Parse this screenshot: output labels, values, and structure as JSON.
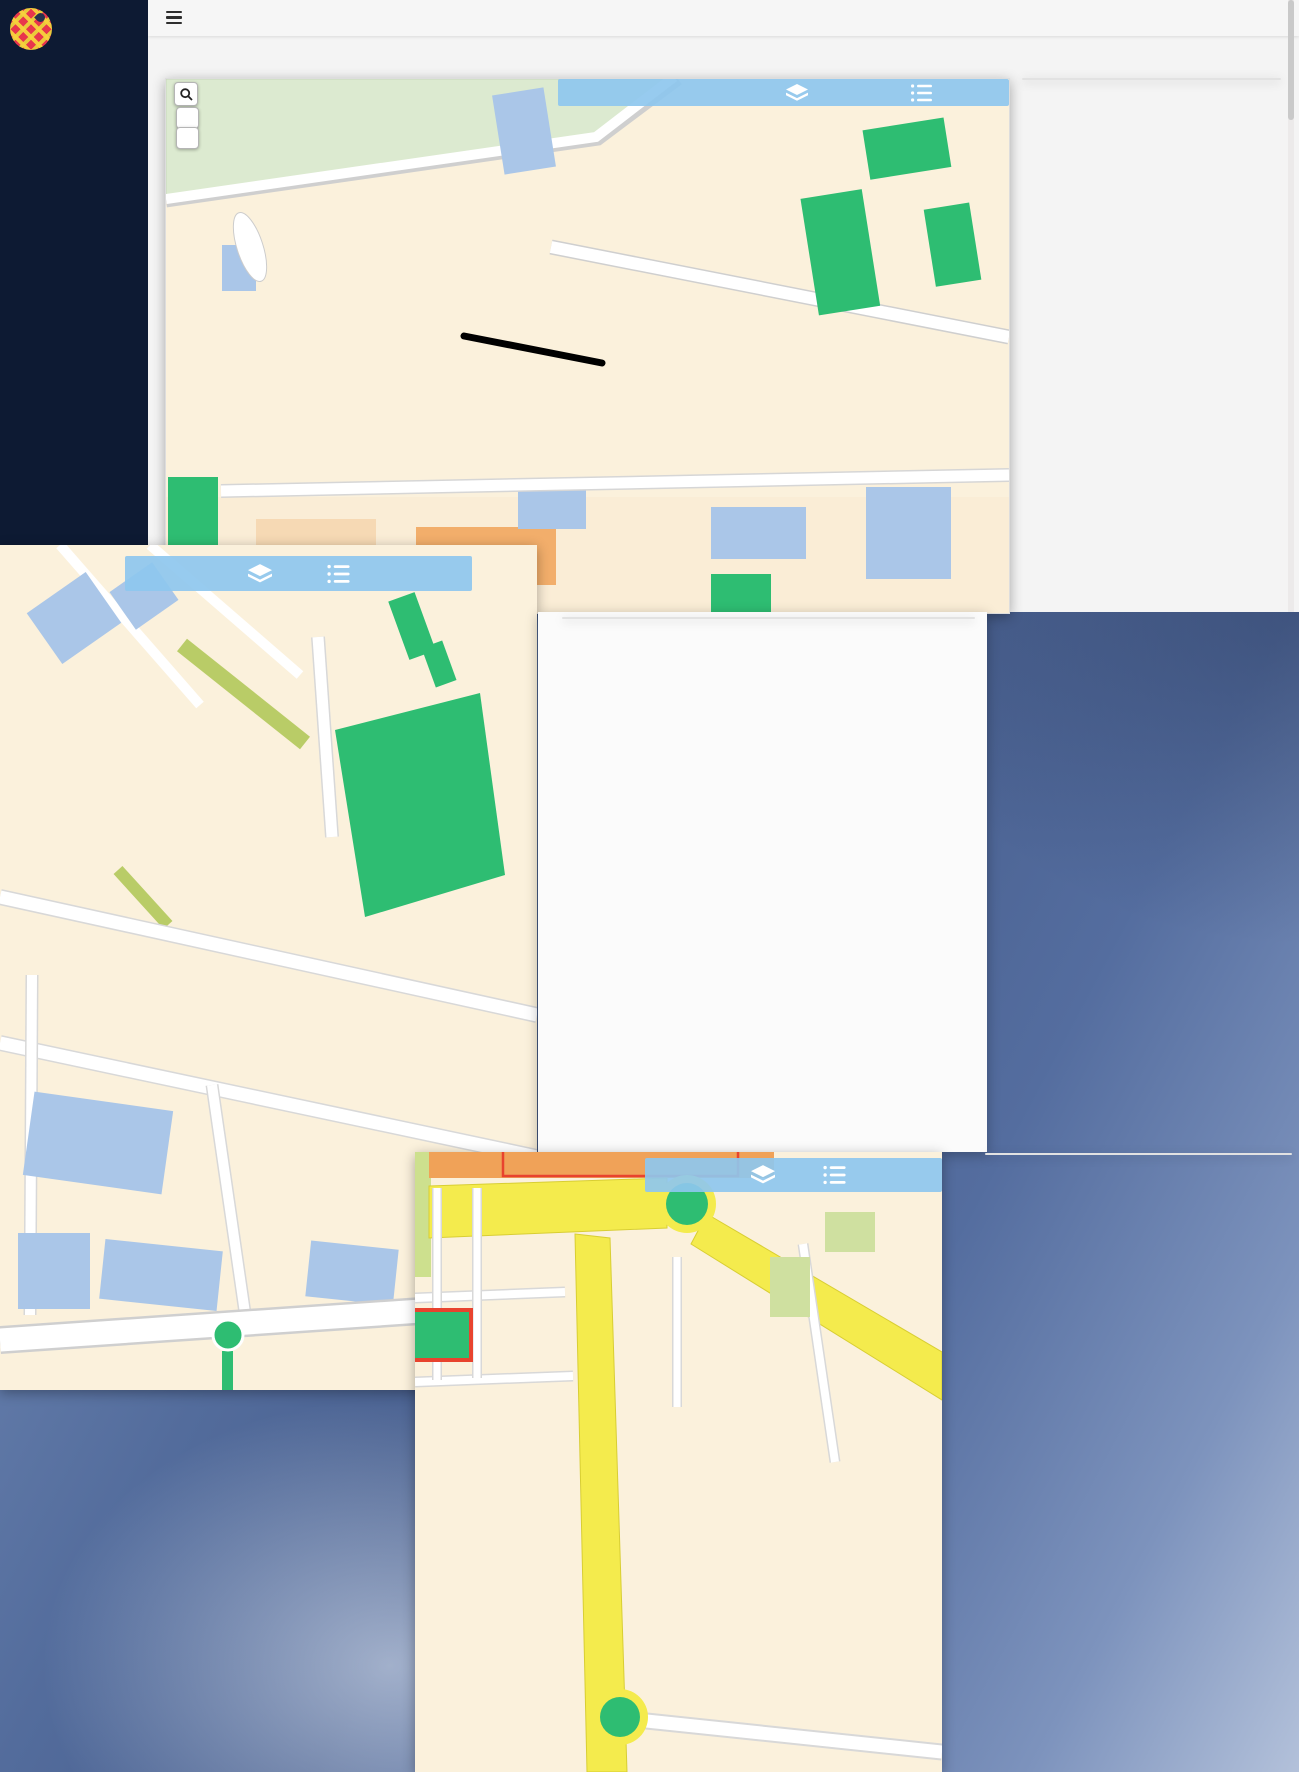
{
  "app": {
    "sidebar": {
      "logo_line1": "BOMBERO",
      "logo_line2": "CALLEJERO",
      "connected_label": "Conectado como:",
      "username": "silviaocon",
      "menu": [
        {
          "icon": "users-icon",
          "label": "Mi cuenta"
        },
        {
          "icon": "folder-icon",
          "label": "Test Interactivos"
        },
        {
          "icon": "file-icon",
          "label": "Simulacros"
        },
        {
          "icon": "list-alt-icon",
          "label": "Test Clásicos"
        },
        {
          "icon": "grid-icon",
          "label": "Mis pedidos"
        },
        {
          "icon": "power-icon",
          "label": "Salir"
        }
      ]
    },
    "topbar": {
      "menu_icon": "hamburger-icon"
    },
    "page_title": "Realizar Test",
    "map_controls": {
      "search_icon": "search-icon",
      "zoom_in_label": "+",
      "zoom_out_label": "−",
      "bar_icons": [
        "layers-icon",
        "list-icon"
      ]
    }
  },
  "common": {
    "question_title_prefix": "Pregunta N°",
    "panel_icons": [
      "heart-icon",
      "envelope-icon"
    ],
    "nav_icons": [
      "chevron-left-icon",
      "chevron-right-icon"
    ],
    "hint": "Marca una de las opciones propuestas.",
    "save_label": "Guardar Test",
    "reset_label": "Reiniciar Test",
    "total_questions": 70
  },
  "questions": [
    {
      "mount": "panel-q1",
      "number": "1",
      "question": "¿Qué calle falta?:",
      "subtitle": "",
      "options": [
        "A - Villa de Oña",
        "B - Pedro de Moya",
        "C - Alcalde Alonso Enríquez",
        "D - Gabriela Mistral"
      ],
      "prev_light": true,
      "grid": {
        "current": 1,
        "wrong": [],
        "correct": []
      }
    },
    {
      "mount": "panel-q2",
      "number": "2",
      "question": "¿En qué calle se ubica?:",
      "subtitle": "Instituto de Astrofísica de Andalucía",
      "options": [
        "A - Joaquín Blume",
        "B - Camino Bajo de Huétor",
        "C - Cuesta del Observatorio",
        "D - Paseo de los Basilios"
      ],
      "prev_light": false,
      "grid": {
        "current": 2,
        "wrong": [],
        "correct": []
      }
    },
    {
      "mount": "panel-q4",
      "number": "4",
      "question": "¿A que distrito pertenece la calle?:",
      "subtitle": "",
      "options": [
        "A - Chana",
        "B - Norte",
        "C - Genil",
        "D - Centro"
      ],
      "prev_light": false,
      "grid": {
        "current": 4,
        "wrong": [
          2
        ],
        "correct": [
          3
        ]
      }
    }
  ],
  "overlays": {
    "right_text": [
      "TRABAJA SOBRE",
      "PLANO NORMAL",
      "PARA COMENZAR A",
      "APRENDER LAS",
      "LOCALIZACIONES"
    ],
    "left_text": [
      "CALLES Y",
      "LUGARES DE",
      "INTERÉS"
    ]
  },
  "maps": {
    "map1": {
      "labels": [
        {
          "t": "o de los Yeseros",
          "x": 62,
          "y": 38,
          "r": -13
        },
        {
          "t": "Juan Niño",
          "x": 292,
          "y": 22,
          "r": -33
        },
        {
          "t": "Maestre Diego",
          "x": 262,
          "y": 58,
          "r": -62
        },
        {
          "t": "Cristóbal Caro",
          "x": 398,
          "y": 34,
          "r": -62
        },
        {
          "t": "Bartolomé de Triana",
          "x": 430,
          "y": 88,
          "r": -62
        },
        {
          "t": "José María Bugella",
          "x": 512,
          "y": 32,
          "r": -12
        },
        {
          "t": "Cándido García Ortiz Villajos",
          "x": 440,
          "y": 152,
          "r": -68
        },
        {
          "t": "Escudero García",
          "x": 598,
          "y": 62,
          "r": -50
        },
        {
          "t": "Fandango",
          "x": 520,
          "y": 96,
          "r": -58
        },
        {
          "t": "Media Granaina",
          "x": 550,
          "y": 124,
          "r": -58
        },
        {
          "t": "Tientos",
          "x": 558,
          "y": 158,
          "r": -58
        },
        {
          "t": "Zambra",
          "x": 516,
          "y": 142,
          "r": -18
        },
        {
          "t": "Bulería",
          "x": 521,
          "y": 178,
          "r": -72
        },
        {
          "t": "Alegría",
          "x": 512,
          "y": 216,
          "r": -72
        },
        {
          "t": "Julio Moreno Dávila",
          "x": 628,
          "y": 124,
          "r": -68
        },
        {
          "t": "José María Bugella",
          "x": 690,
          "y": 118,
          "r": -68
        },
        {
          "t": "Parque Veintiocho de Febrero",
          "x": 663,
          "y": 170,
          "r": -62,
          "c": "#2e7d4f"
        },
        {
          "t": "Fray Juan Sánchez Cotán",
          "x": 520,
          "y": 210,
          "r": 9
        },
        {
          "t": "Alejandro Dumas",
          "x": 668,
          "y": 242,
          "r": 9
        },
        {
          "t": "Blas de Ledesma",
          "x": 352,
          "y": 188,
          "r": -7
        },
        {
          "t": "Baltas",
          "x": 312,
          "y": 238,
          "r": -7
        },
        {
          "t": "Luis Rodríguez B",
          "x": 384,
          "y": 248,
          "r": 10
        },
        {
          "t": "Ambrosio",
          "x": 434,
          "y": 250,
          "r": -70
        },
        {
          "t": "José de Mora",
          "x": 388,
          "y": 302,
          "r": -5
        },
        {
          "t": "Hermanos García",
          "x": 393,
          "y": 318,
          "r": -5
        },
        {
          "t": "Pedro de Mena",
          "x": 302,
          "y": 326,
          "r": -5
        },
        {
          "t": "Jerónimo Sinest",
          "x": 330,
          "y": 356,
          "r": -5
        },
        {
          "t": "Rodrigo de Esc",
          "x": 252,
          "y": 152,
          "r": -80
        },
        {
          "t": "Antonio Calabrés",
          "x": 258,
          "y": 128,
          "r": -8
        },
        {
          "t": "Bartolomé Roldán",
          "x": 268,
          "y": 252,
          "r": -80
        },
        {
          "t": "Linares",
          "x": 212,
          "y": 228,
          "r": -80
        },
        {
          "t": "Elcano",
          "x": 232,
          "y": 242,
          "r": -80
        },
        {
          "t": "Torredonjimeno",
          "x": 198,
          "y": 264,
          "r": -8
        },
        {
          "t": "Úbeda",
          "x": 218,
          "y": 298,
          "r": -8
        },
        {
          "t": "Canarios",
          "x": 254,
          "y": 300,
          "r": -8
        },
        {
          "t": "Murcia",
          "x": 232,
          "y": 318,
          "r": -8
        },
        {
          "t": "La Línea",
          "x": 218,
          "y": 336,
          "r": -8
        },
        {
          "t": "Vélez de Gomera",
          "x": 280,
          "y": 366,
          "r": -8
        },
        {
          "t": "Juan de Palenque",
          "x": 324,
          "y": 378,
          "r": -8
        },
        {
          "t": "Caserío del Cerro",
          "x": 92,
          "y": 340,
          "r": -78
        },
        {
          "t": "Pastor Joaquín Capulino Jáuregui",
          "x": 38,
          "y": 300,
          "r": -78
        },
        {
          "t": "José Morcillo",
          "x": 64,
          "y": 312,
          "r": -78
        },
        {
          "t": "Plaza Rey Badis",
          "x": 80,
          "y": 178,
          "r": -20
        },
        {
          "t": "Pedro Machuca",
          "x": 342,
          "y": 408,
          "r": -2
        },
        {
          "t": "José Manuel Baena Martí",
          "x": 680,
          "y": 320,
          "r": -75
        },
        {
          "t": "Pintor Chavarino",
          "x": 548,
          "y": 302,
          "r": -78
        }
      ],
      "markers": [
        [
          362,
          35
        ],
        [
          40,
          350
        ],
        [
          105,
          365
        ],
        [
          195,
          434
        ],
        [
          290,
          439
        ],
        [
          395,
          444
        ],
        [
          540,
          419
        ],
        [
          640,
          359
        ],
        [
          512,
          329
        ],
        [
          740,
          422
        ],
        [
          400,
          517
        ],
        [
          565,
          517
        ],
        [
          747,
          514
        ]
      ],
      "dots": [
        [
          250,
          90
        ],
        [
          300,
          140
        ],
        [
          470,
          130
        ],
        [
          610,
          95
        ],
        [
          660,
          140
        ],
        [
          700,
          180
        ],
        [
          540,
          210
        ],
        [
          430,
          180
        ],
        [
          380,
          330
        ],
        [
          300,
          390
        ],
        [
          620,
          300
        ],
        [
          680,
          360
        ],
        [
          200,
          430
        ],
        [
          90,
          420
        ]
      ]
    },
    "map2": {
      "labels": [
        {
          "t": "José María Bugella",
          "x": 85,
          "y": 52,
          "r": -10
        },
        {
          "t": "Cándido Gar",
          "x": 68,
          "y": 122,
          "r": -70
        },
        {
          "t": "Ortiz de Triana",
          "x": 22,
          "y": 95,
          "r": -72
        },
        {
          "t": "do García Ortiz Villajos",
          "x": 12,
          "y": 238,
          "r": -80
        },
        {
          "t": "Serranas",
          "x": 228,
          "y": 130,
          "r": -36
        },
        {
          "t": "Escudero García",
          "x": 294,
          "y": 148,
          "r": -36
        },
        {
          "t": "Plaza Jesús de",
          "x": 298,
          "y": 106,
          "r": -75,
          "s": 7.5
        },
        {
          "t": "Fandango",
          "x": 148,
          "y": 175,
          "r": -40
        },
        {
          "t": "Media Granaina",
          "x": 192,
          "y": 216,
          "r": -58
        },
        {
          "t": "Tientos",
          "x": 213,
          "y": 253,
          "r": -58
        },
        {
          "t": "Zambra",
          "x": 162,
          "y": 240,
          "r": -18
        },
        {
          "t": "Rondeña",
          "x": 253,
          "y": 258,
          "r": -72
        },
        {
          "t": "Soleá",
          "x": 140,
          "y": 262,
          "r": -25
        },
        {
          "t": "Plaza de",
          "x": 131,
          "y": 290,
          "r": -72,
          "s": 7.5
        },
        {
          "t": "Bulería",
          "x": 178,
          "y": 303,
          "r": -75
        },
        {
          "t": "Alegría",
          "x": 142,
          "y": 348,
          "r": -75
        },
        {
          "t": "Julio Moreno Dávila",
          "x": 313,
          "y": 160,
          "r": -70
        },
        {
          "t": "José María Bugella",
          "x": 420,
          "y": 192,
          "r": -12
        },
        {
          "t": "Henríquez",
          "x": 458,
          "y": 128,
          "r": -25
        },
        {
          "t": "Parque Veintiocho de Febrer",
          "x": 400,
          "y": 264,
          "r": -62,
          "c": "#2e7d4f"
        },
        {
          "t": "Fray Juan Sánchez Cotán",
          "x": 118,
          "y": 378,
          "r": 13
        },
        {
          "t": "Alejandro Dumas",
          "x": 120,
          "y": 512,
          "r": 13
        },
        {
          "t": "Pintor Chavarito",
          "x": 28,
          "y": 522,
          "r": -82
        },
        {
          "t": "rosio",
          "x": 10,
          "y": 428,
          "r": -82,
          "s": 7.5
        },
        {
          "t": "José Manuel Baena Martí",
          "x": 229,
          "y": 618,
          "r": -80
        },
        {
          "t": "José Ma",
          "x": 250,
          "y": 745,
          "r": -75,
          "s": 7.5
        }
      ],
      "markers": [
        [
          70,
          95
        ],
        [
          160,
          530
        ],
        [
          345,
          590
        ],
        [
          278,
          763
        ],
        [
          373,
          735
        ]
      ],
      "dots": [
        [
          320,
          480
        ],
        [
          230,
          500
        ],
        [
          150,
          470
        ],
        [
          420,
          560
        ],
        [
          90,
          620
        ],
        [
          260,
          690
        ],
        [
          380,
          700
        ],
        [
          120,
          720
        ],
        [
          440,
          640
        ],
        [
          60,
          560
        ]
      ]
    },
    "map3": {
      "labels": [
        {
          "t": "Ronda de Cer",
          "x": 278,
          "y": 58,
          "r": -38
        },
        {
          "t": "José Tamayo",
          "x": 462,
          "y": 186,
          "r": -20,
          "s": 9
        },
        {
          "t": "Sanchica",
          "x": 18,
          "y": 100,
          "r": -85
        },
        {
          "t": "Don Quijote",
          "x": 58,
          "y": 100,
          "r": -85
        },
        {
          "t": "Virgen del Rocío",
          "x": 42,
          "y": 148,
          "r": -3
        },
        {
          "t": "Plaza del Rocío",
          "x": 20,
          "y": 186,
          "r": -40,
          "s": 7
        },
        {
          "t": "Poeta Eduardo Carranza",
          "x": 56,
          "y": 222,
          "r": -2
        },
        {
          "t": "Sancho Panza",
          "x": 176,
          "y": 128,
          "r": -85
        },
        {
          "t": "Colonia",
          "x": 262,
          "y": 132,
          "r": -85
        },
        {
          "t": "Cervantes",
          "x": 274,
          "y": 152,
          "r": -35
        },
        {
          "t": "Santa Luisa de Marillac",
          "x": 387,
          "y": 155,
          "r": -72
        },
        {
          "t": "Glorieta de la Astronomía",
          "x": 172,
          "y": 548,
          "r": -55
        },
        {
          "t": "Camino Bajo de Huétor",
          "x": 352,
          "y": 556,
          "r": -10,
          "s": 9
        }
      ],
      "markers": [
        [
          370,
          12
        ],
        [
          100,
          -4
        ],
        [
          20,
          178
        ],
        [
          225,
          310
        ],
        [
          243,
          560
        ]
      ],
      "dots": [
        [
          80,
          60
        ],
        [
          300,
          270
        ],
        [
          420,
          330
        ]
      ]
    }
  }
}
